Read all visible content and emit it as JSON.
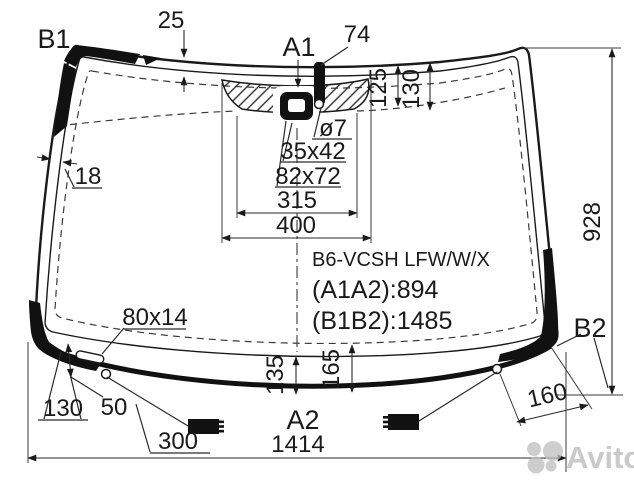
{
  "labels": {
    "b1": "B1",
    "a1": "A1",
    "a2": "A2",
    "b2": "B2"
  },
  "dims": {
    "top_band": "25",
    "sensor_strip": "74",
    "band_left": "125",
    "band_right": "130",
    "hole_dia": "ø7",
    "mount": "35x42",
    "opening": "82x72",
    "shade_bottom": "315",
    "shade_top": "400",
    "edge_band": "18",
    "height": "928",
    "slot": "80x14",
    "corner_slot": "130",
    "edge_gap": "50",
    "hole_offset": "300",
    "inner_offset": "135",
    "band_bottom": "165",
    "corner_hole": "160",
    "width": "1414"
  },
  "info": {
    "part_code": "B6-VCSH LFW/W/X",
    "a1a2": "(A1A2):894",
    "b1b2": "(B1B2):1485"
  },
  "watermark": {
    "brand": "Avito"
  },
  "colors": {
    "line": "#1a1a1a",
    "dim": "#2a2a2a",
    "watermark": "#bdbdbd"
  }
}
